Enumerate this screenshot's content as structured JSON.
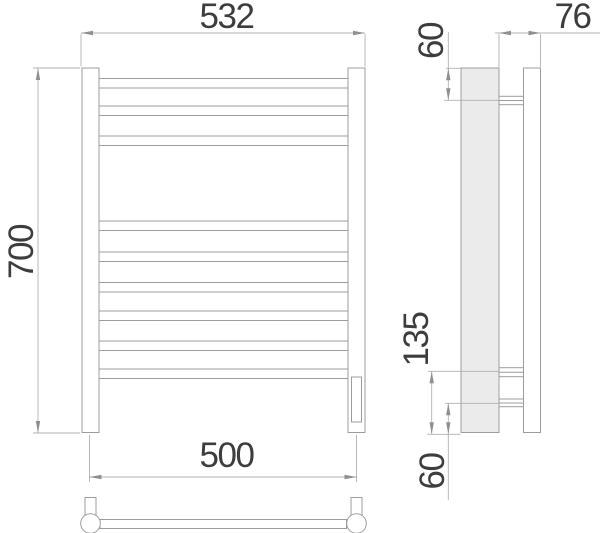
{
  "drawing": {
    "type": "towel-rail-technical-drawing",
    "views": [
      "front-view",
      "side-view",
      "bottom-view"
    ],
    "dimensions": {
      "overall_width": "532",
      "overall_height": "700",
      "rail_length": "500",
      "top_bracket_offset": "60",
      "depth": "76",
      "bracket_spacing": "135",
      "bottom_bracket_offset": "60"
    },
    "colors": {
      "background": "#ffffff",
      "object_line": "#9c9c9c",
      "dimension_line": "#b0b0b0",
      "arrow": "#8f8f8f",
      "text": "#3d3d3d",
      "shaded_fill": "#ebebeb"
    }
  }
}
